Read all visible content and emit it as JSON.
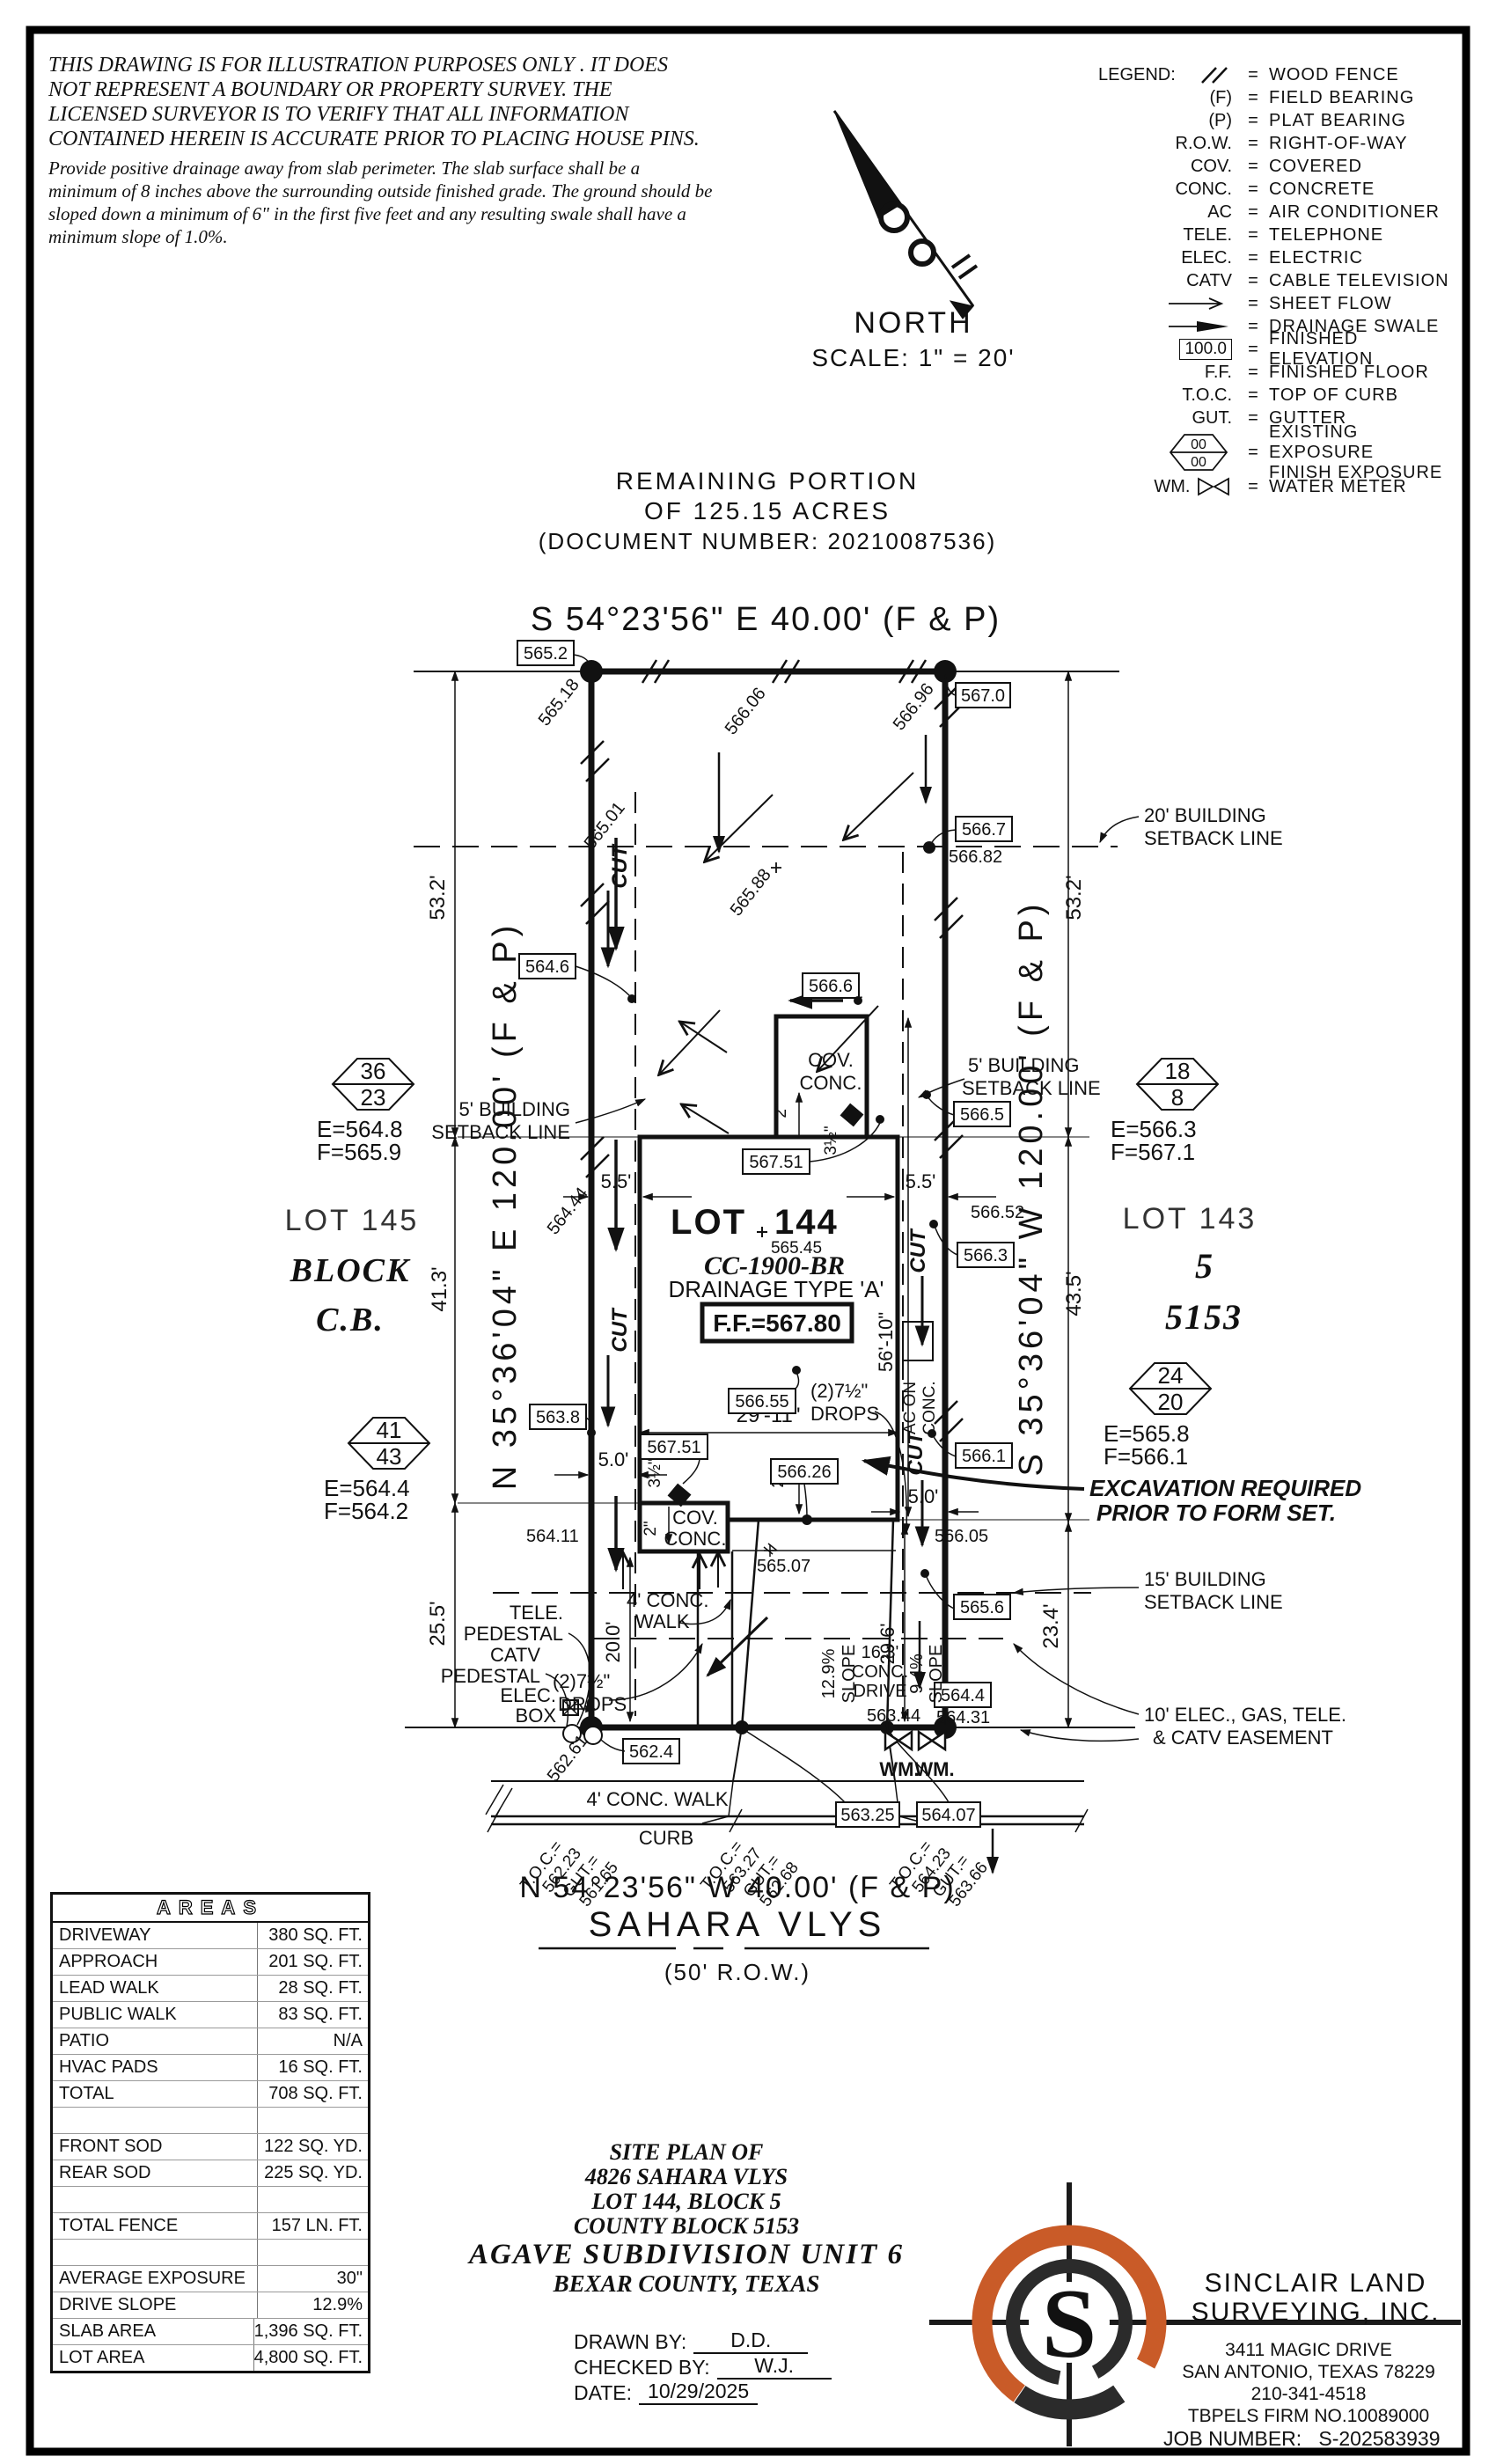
{
  "disclaimer": {
    "cap_lines": [
      "THIS DRAWING IS FOR ILLUSTRATION PURPOSES ONLY . IT DOES",
      "NOT REPRESENT A BOUNDARY OR PROPERTY SURVEY. THE",
      "LICENSED SURVEYOR IS TO VERIFY THAT ALL INFORMATION",
      "CONTAINED HEREIN IS ACCURATE PRIOR TO PLACING HOUSE PINS."
    ],
    "note_lines": [
      "Provide positive drainage away from slab perimeter. The slab surface shall be a",
      "minimum of 8 inches above the surrounding outside finished grade. The ground should be",
      "sloped down a minimum of 6\" in the first five feet and any resulting swale shall have a",
      "minimum slope of 1.0%."
    ]
  },
  "legend": {
    "title": "LEGEND:",
    "eq": "=",
    "items": [
      {
        "sym": "",
        "desc": "WOOD FENCE"
      },
      {
        "sym": "(F)",
        "desc": "FIELD BEARING"
      },
      {
        "sym": "(P)",
        "desc": "PLAT BEARING"
      },
      {
        "sym": "R.O.W.",
        "desc": "RIGHT-OF-WAY"
      },
      {
        "sym": "COV.",
        "desc": "COVERED"
      },
      {
        "sym": "CONC.",
        "desc": "CONCRETE"
      },
      {
        "sym": "AC",
        "desc": "AIR CONDITIONER"
      },
      {
        "sym": "TELE.",
        "desc": "TELEPHONE"
      },
      {
        "sym": "ELEC.",
        "desc": "ELECTRIC"
      },
      {
        "sym": "CATV",
        "desc": "CABLE TELEVISION"
      },
      {
        "sym": "",
        "desc": "SHEET FLOW"
      },
      {
        "sym": "",
        "desc": "DRAINAGE SWALE"
      },
      {
        "sym": "100.0",
        "desc": "FINISHED ELEVATION"
      },
      {
        "sym": "F.F.",
        "desc": "FINISHED FLOOR"
      },
      {
        "sym": "T.O.C.",
        "desc": "TOP OF CURB"
      },
      {
        "sym": "GUT.",
        "desc": "GUTTER"
      },
      {
        "sym": "00",
        "sym2": "00",
        "desc": "EXISTING EXPOSURE",
        "desc2": "FINISH EXPOSURE"
      },
      {
        "sym": "WM.",
        "desc": "WATER METER"
      }
    ]
  },
  "north": {
    "label": "NORTH",
    "scale": "SCALE:  1\" = 20'"
  },
  "header": {
    "remaining1": "REMAINING  PORTION",
    "remaining2": "OF  125.15  ACRES",
    "docnum": "(DOCUMENT  NUMBER:  20210087536)",
    "bearing_top": "S  54°23'56\"  E  40.00'  (F  &  P)"
  },
  "street": {
    "bearing": "N  54°23'56\"  W  40.00'  (F  &  P)",
    "name": "SAHARA  VLYS",
    "row": "(50'  R.O.W.)"
  },
  "plan": {
    "bearing_left": "N  35°36'04\"  E  120.00'  (F  &  P)",
    "bearing_right": "S  35°36'04\"  W  120.00'  (F  &  P)",
    "lot145": {
      "l1": "LOT  145",
      "l2": "BLOCK",
      "l3": "C.B."
    },
    "lot143": {
      "l1": "LOT  143",
      "l2": "5",
      "l3": "5153"
    },
    "lot144": {
      "name": "LOT",
      "num": "144",
      "spot": "565.45",
      "model": "CC-1900-BR",
      "type": "DRAINAGE  TYPE  'A'",
      "ff": "F.F.=567.80"
    },
    "hexes": [
      {
        "a": "36",
        "b": "23",
        "e": "E=564.8",
        "f": "F=565.9"
      },
      {
        "a": "41",
        "b": "43",
        "e": "E=564.4",
        "f": "F=564.2"
      },
      {
        "a": "18",
        "b": "8",
        "e": "E=566.3",
        "f": "F=567.1"
      },
      {
        "a": "24",
        "b": "20",
        "e": "E=565.8",
        "f": "F=566.1"
      }
    ],
    "excavation": {
      "l1": "EXCAVATION REQUIRED",
      "l2": "PRIOR TO FORM SET."
    },
    "setbacks": {
      "s20a": "20' BUILDING",
      "s20b": "SETBACK LINE",
      "s5a": "5' BUILDING",
      "s5b": "SETBACK LINE",
      "s15a": "15' BUILDING",
      "s15b": "SETBACK LINE",
      "easa": "10' ELEC., GAS, TELE.",
      "easb": "& CATV EASEMENT"
    },
    "dims": {
      "d53": "53.2'",
      "d413": "41.3'",
      "d255": "25.5'",
      "d435": "43.5'",
      "d234": "23.4'",
      "d296": "29.6'",
      "d200": "20.0'",
      "d55": "5.5'",
      "d50": "5.0'",
      "d2911": "29'-11\"",
      "d5610": "56'-10\"",
      "d2": "2\"",
      "d35": "3½\""
    },
    "boxes": {
      "e5652": "565.2",
      "e5670": "567.0",
      "e5667": "566.7",
      "e5646": "564.6",
      "e5666": "566.6",
      "e5665": "566.5",
      "e56751a": "567.51",
      "e5663": "566.3",
      "e56655": "566.55",
      "e5661": "566.1",
      "e56751b": "567.51",
      "e56626": "566.26",
      "e5638": "563.8",
      "e5656": "565.6",
      "e5644": "564.4",
      "e5624": "562.4",
      "e56325": "563.25",
      "e56407": "564.07"
    },
    "spots": {
      "s56518": "565.18",
      "s56606": "566.06",
      "s56696": "566.96",
      "s56501": "565.01",
      "s56588": "565.88",
      "s56682": "566.82",
      "s56652": "566.52",
      "s56444": "564.44",
      "s56411": "564.11",
      "s56507": "565.07",
      "s56605": "566.05",
      "s56261": "562.61",
      "s56344": "563.44",
      "s56431": "564.31"
    },
    "features": {
      "cut": "CUT",
      "cov1": "COV.",
      "cov2": "CONC.",
      "ac1": "AC ON",
      "ac2": "CONC.",
      "tele": "TELE.",
      "ped": "PEDESTAL",
      "catv": "CATV",
      "elec": "ELEC.",
      "box": "BOX",
      "wm": "WM.",
      "walk1": "4' CONC.",
      "walk2": "WALK",
      "walk_label": "4'  CONC.  WALK",
      "curb": "CURB",
      "drive1": "16.3'",
      "drive2": "CONC.",
      "drive3": "DRIVE",
      "slope1": "12.9%",
      "slope2": "9.4%",
      "slope": "SLOPE",
      "drops1": "(2)7½\"",
      "drops2": "DROPS"
    },
    "toc": [
      {
        "t": "T.O.C.=",
        "tv": "562.23",
        "g": "GUT.=",
        "gv": "561.65"
      },
      {
        "t": "T.O.C.=",
        "tv": "563.27",
        "g": "GUT.=",
        "gv": "562.68"
      },
      {
        "t": "T.O.C.=",
        "tv": "564.23",
        "g": "GUT.=",
        "gv": "563.66"
      }
    ]
  },
  "areas": {
    "title": "AREAS",
    "rows": [
      {
        "label": "DRIVEWAY",
        "value": "380 SQ. FT."
      },
      {
        "label": "APPROACH",
        "value": "201 SQ. FT."
      },
      {
        "label": "LEAD WALK",
        "value": "28 SQ. FT."
      },
      {
        "label": "PUBLIC WALK",
        "value": "83 SQ. FT."
      },
      {
        "label": "PATIO",
        "value": "N/A"
      },
      {
        "label": "HVAC PADS",
        "value": "16 SQ. FT."
      },
      {
        "label": "TOTAL",
        "value": "708 SQ. FT."
      },
      {
        "label": "",
        "value": ""
      },
      {
        "label": "FRONT SOD",
        "value": "122 SQ. YD."
      },
      {
        "label": "REAR SOD",
        "value": "225 SQ. YD."
      },
      {
        "label": "",
        "value": ""
      },
      {
        "label": "TOTAL FENCE",
        "value": "157 LN. FT."
      },
      {
        "label": "",
        "value": ""
      },
      {
        "label": "AVERAGE EXPOSURE",
        "value": "30\""
      },
      {
        "label": "DRIVE SLOPE",
        "value": "12.9%"
      },
      {
        "label": "SLAB AREA",
        "value": "1,396 SQ. FT."
      },
      {
        "label": "LOT AREA",
        "value": "4,800 SQ. FT."
      }
    ]
  },
  "titleblock": {
    "lines": [
      "SITE  PLAN  OF",
      "4826  SAHARA  VLYS",
      "LOT  144,  BLOCK  5",
      "COUNTY  BLOCK  5153",
      "AGAVE  SUBDIVISION  UNIT  6",
      "BEXAR  COUNTY,  TEXAS"
    ],
    "drawn_label": "DRAWN  BY:",
    "drawn": "D.D.",
    "checked_label": "CHECKED  BY:",
    "checked": "W.J.",
    "date_label": "DATE:",
    "date": "10/29/2025"
  },
  "firm": {
    "name1": "SINCLAIR  LAND",
    "name2": "SURVEYING,  INC.",
    "addr1": "3411  MAGIC  DRIVE",
    "addr2": "SAN  ANTONIO,  TEXAS  78229",
    "phone": "210-341-4518",
    "firm_no": "TBPELS  FIRM  NO.10089000",
    "job_label": "JOB  NUMBER:",
    "job": "S-202583939",
    "logo_letter": "S",
    "orange": "#C95B28"
  }
}
